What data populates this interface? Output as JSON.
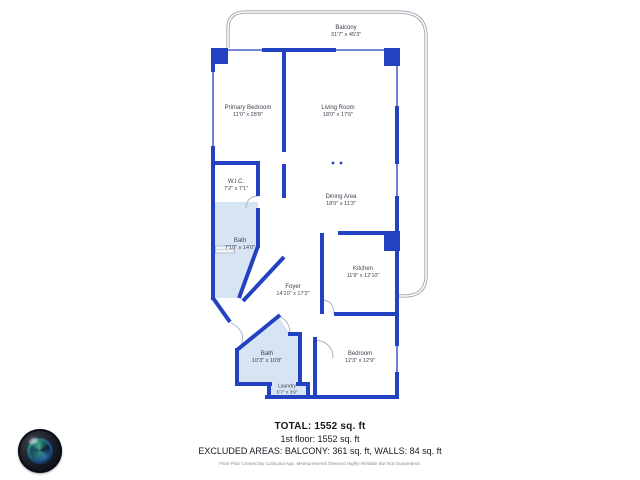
{
  "summary": {
    "total": "TOTAL: 1552 sq. ft",
    "floor1": "1st floor: 1552 sq. ft",
    "excluded": "EXCLUDED AREAS: BALCONY: 361 sq. ft, WALLS: 84 sq. ft",
    "note": "Floor Plan Created By Cubicasa App. Measurements Deemed Highly Reliable But Not Guaranteed."
  },
  "rooms": [
    {
      "name": "Balcony",
      "dims": "31'7\" x 45'3\""
    },
    {
      "name": "Primary Bedroom",
      "dims": "11'0\" x 28'8\""
    },
    {
      "name": "Living Room",
      "dims": "18'0\" x 17'6\""
    },
    {
      "name": "W.I.C.",
      "dims": "7'2\" x 7'1\""
    },
    {
      "name": "Dining Area",
      "dims": "18'0\" x 11'3\""
    },
    {
      "name": "Bath",
      "dims": "7'10\" x 14'0\""
    },
    {
      "name": "Kitchen",
      "dims": "11'9\" x 12'10\""
    },
    {
      "name": "Foyer",
      "dims": "14'10\" x 17'2\""
    },
    {
      "name": "Bath",
      "dims": "10'3\" x 10'8\""
    },
    {
      "name": "Bedroom",
      "dims": "12'3\" x 12'9\""
    },
    {
      "name": "Laundry",
      "dims": "5'7\" x 3'9\""
    }
  ],
  "colors": {
    "wall": "#2342c1",
    "room_fill": "#d7e4f4",
    "balcony_line": "#9aa2ab",
    "label_text": "#3d4351"
  },
  "icons": {
    "logo": "camera-lens-globe-logo"
  }
}
